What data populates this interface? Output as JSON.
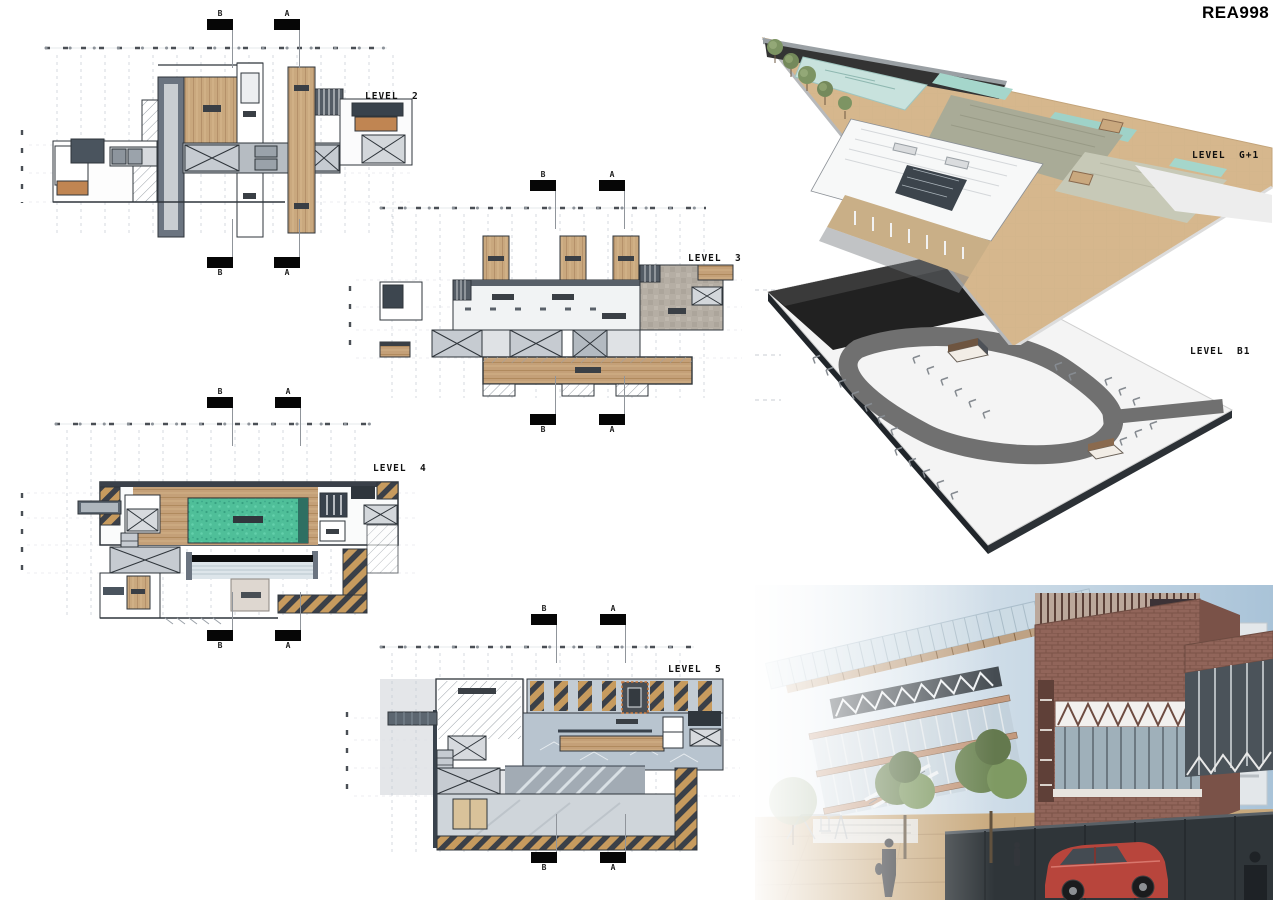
{
  "board": {
    "code": "REA998"
  },
  "markers": {
    "b": "B",
    "a": "A"
  },
  "plans": [
    {
      "label": "LEVEL  2"
    },
    {
      "label": "LEVEL  3"
    },
    {
      "label": "LEVEL  4"
    },
    {
      "label": "LEVEL  5"
    }
  ],
  "axonometrics": [
    {
      "label": "LEVEL  G+1"
    },
    {
      "label": "LEVEL  B1"
    }
  ],
  "palette": {
    "wood": "#c9a87e",
    "slate": "#5c6670",
    "gray_floor": "#b9bfc6",
    "pool_teal": "#4fbf99",
    "site_tan": "#d8ba90",
    "road_gray": "#707070",
    "brick": "#8e6257",
    "sky_blue": "#a9c3d8",
    "car_red": "#b8453c",
    "hatch_tan": "#c79b5e",
    "hatch_dark": "#3b4048"
  }
}
